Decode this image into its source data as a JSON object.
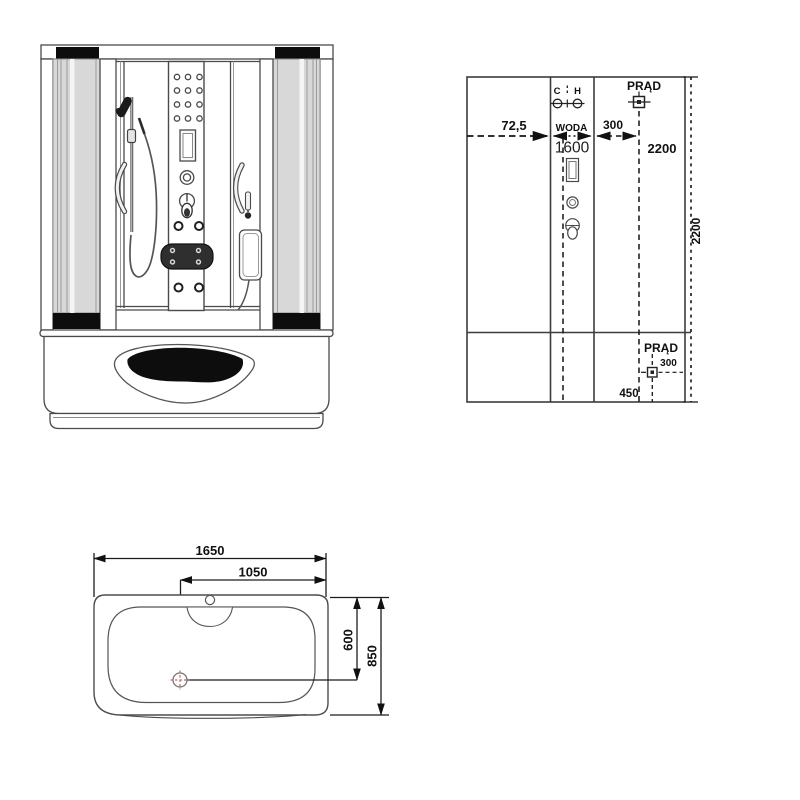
{
  "drawing": {
    "type": "technical installation drawing",
    "subject": "steam shower cabin with whirlpool bathtub"
  },
  "colors": {
    "line": "#4a4a4a",
    "dimension_line": "#1c1c1c",
    "glass_fill": "#d8d8d8",
    "black_fill": "#0d0d0d",
    "drain_accent": "#c46a6a",
    "background": "#ffffff"
  },
  "installation_diagram": {
    "labels": {
      "cold": "C",
      "hot": "H",
      "power_top": "PRĄD",
      "offset_left": "72,5",
      "water": "WODA",
      "water_to_power": "300",
      "water_height": "1600",
      "power_height": "2200",
      "total_height": "2200",
      "power_bottom": "PRĄD",
      "power_bottom_height": "300",
      "power_bottom_offset": "450"
    }
  },
  "top_view": {
    "labels": {
      "total_length": "1650",
      "drain_offset": "1050",
      "drain_depth": "600",
      "total_width": "850"
    }
  }
}
